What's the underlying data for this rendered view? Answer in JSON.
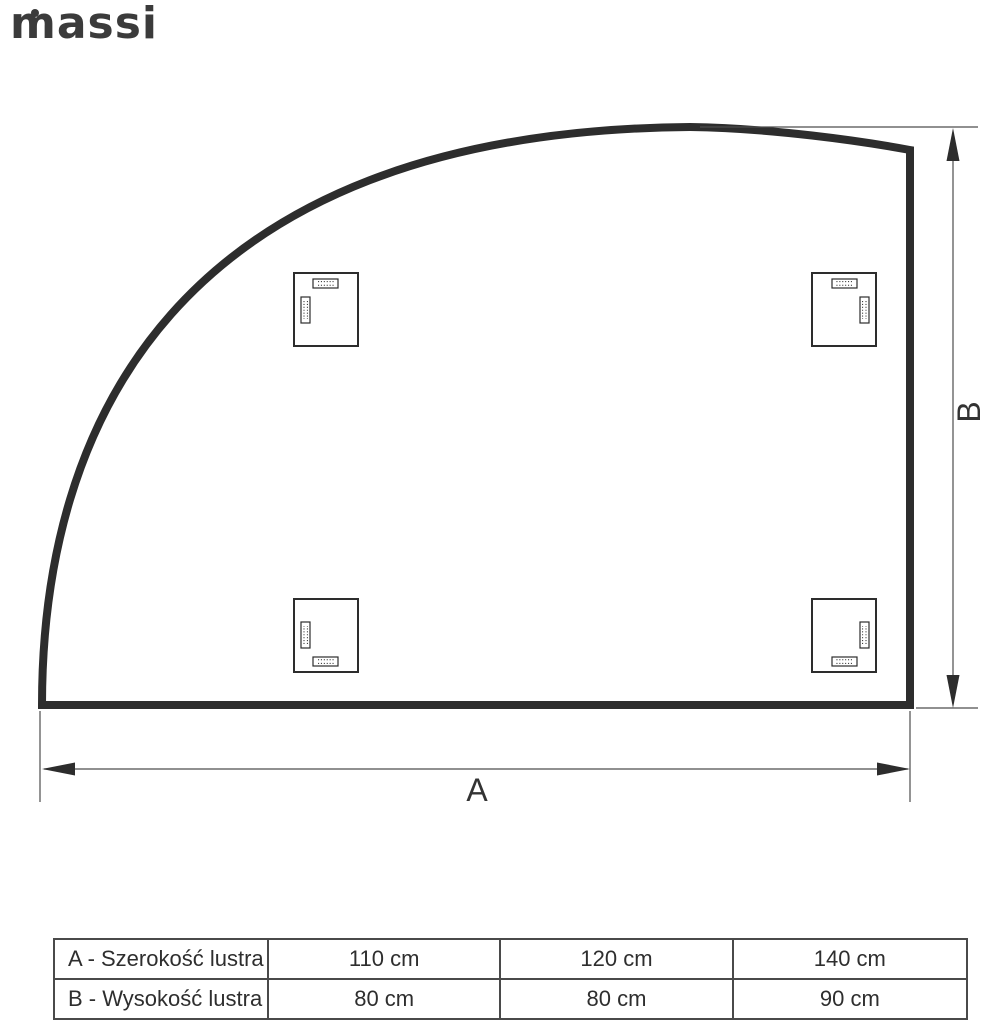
{
  "logo": {
    "text": "massi"
  },
  "diagram": {
    "width_label": "A",
    "height_label": "B",
    "mount_brackets_count": 4
  },
  "size_table": {
    "rows": [
      {
        "label": "A - Szerokość lustra",
        "values": [
          "110 cm",
          "120 cm",
          "140 cm"
        ]
      },
      {
        "label": "B - Wysokość lustra",
        "values": [
          "80 cm",
          "80 cm",
          "90 cm"
        ]
      }
    ]
  },
  "colors": {
    "outline": "#2d2d2d",
    "dimension_lines": "#4d4d4d",
    "text": "#333333",
    "background": "#ffffff"
  }
}
